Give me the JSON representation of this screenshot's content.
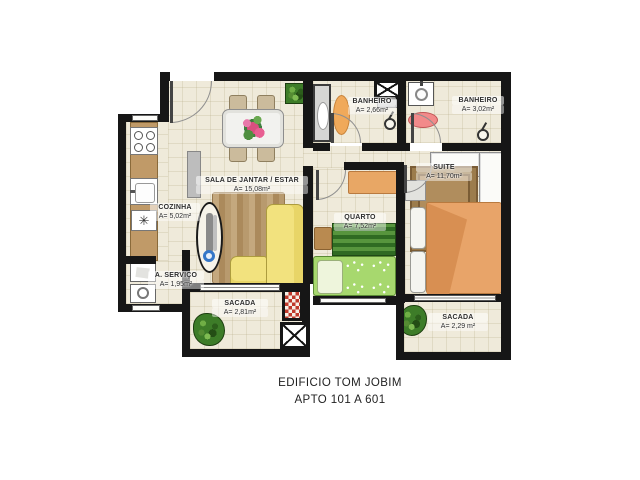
{
  "title": {
    "line1": "EDIFICIO TOM JOBIM",
    "line2": "APTO 101 A 601"
  },
  "rooms": {
    "sala": {
      "name": "SALA DE JANTAR / ESTAR",
      "area": "A= 15,08m²"
    },
    "cozinha": {
      "name": "COZINHA",
      "area": "A= 5,02m²"
    },
    "servico": {
      "name": "A. SERVIÇO",
      "area": "A= 1,95m²"
    },
    "banheiro1": {
      "name": "BANHEIRO",
      "area": "A= 2,66m²"
    },
    "banheiro2": {
      "name": "BANHEIRO",
      "area": "A= 3,02m²"
    },
    "quarto": {
      "name": "QUARTO",
      "area": "A= 7,52m²"
    },
    "suite": {
      "name": "SUITE",
      "area": "A= 11,70m²"
    },
    "sacada1": {
      "name": "SACADA",
      "area": "A= 2,81m²"
    },
    "sacada2": {
      "name": "SACADA",
      "area": "A= 2,29 m²"
    }
  },
  "symbols": {
    "cooktop_fan": "✳"
  },
  "colors": {
    "wall": "#161616",
    "floor": "#efeada",
    "sofa": "#f2e27e",
    "single_bed": "#a7d86e",
    "double_bed": "#e8a469",
    "kitchen_counter": "#c09a68",
    "suite_rug": "#b08d5d",
    "plant": "#3d7c28",
    "grill": "#c0392b",
    "bath1_rug": "#f0a95a",
    "bath2_rug": "#f28a8a"
  }
}
